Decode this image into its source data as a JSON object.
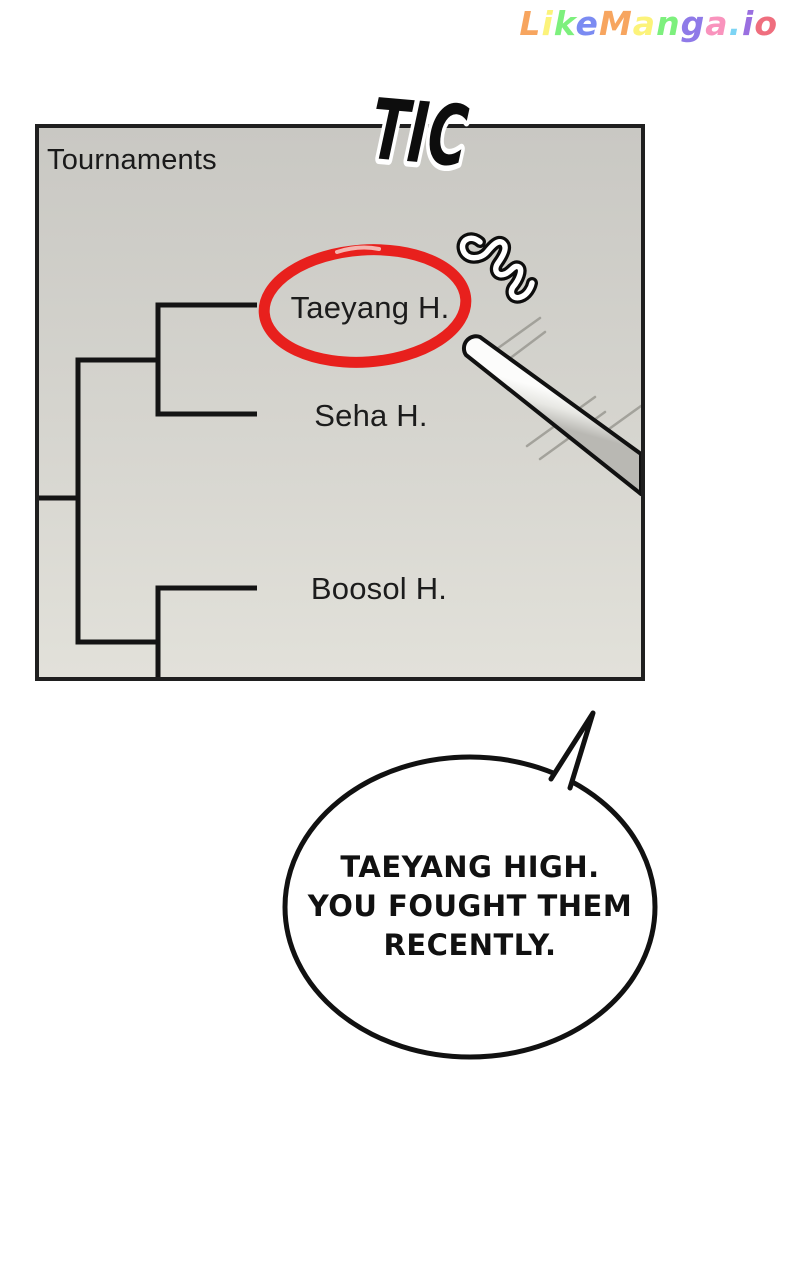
{
  "watermark": {
    "text": "LikeManga.io",
    "letters": [
      {
        "ch": "L",
        "color": "#f7a55f"
      },
      {
        "ch": "i",
        "color": "#fcf37a"
      },
      {
        "ch": "k",
        "color": "#7df07d"
      },
      {
        "ch": "e",
        "color": "#7b8bf2"
      },
      {
        "ch": "M",
        "color": "#f7a55f"
      },
      {
        "ch": "a",
        "color": "#fcf37a"
      },
      {
        "ch": "n",
        "color": "#7df07d"
      },
      {
        "ch": "g",
        "color": "#8f7ae8"
      },
      {
        "ch": "a",
        "color": "#f993bd"
      },
      {
        "ch": ".",
        "color": "#7cd4f4"
      },
      {
        "ch": "i",
        "color": "#9a6fe0"
      },
      {
        "ch": "o",
        "color": "#ef6e7e"
      }
    ]
  },
  "sfx": {
    "label": "TIC"
  },
  "panel": {
    "title": "Tournaments",
    "bracket": {
      "teams": [
        {
          "name": "Taeyang H.",
          "highlighted": true
        },
        {
          "name": "Seha H.",
          "highlighted": false
        },
        {
          "name": "Boosol H.",
          "highlighted": false
        }
      ],
      "line_color": "#141414"
    },
    "highlight_color": "#e8201d",
    "background_top": "#c9c8c3",
    "background_bottom": "#e2e1da"
  },
  "bubble": {
    "lines": [
      "TAEYANG HIGH.",
      "YOU FOUGHT THEM",
      "RECENTLY."
    ]
  }
}
